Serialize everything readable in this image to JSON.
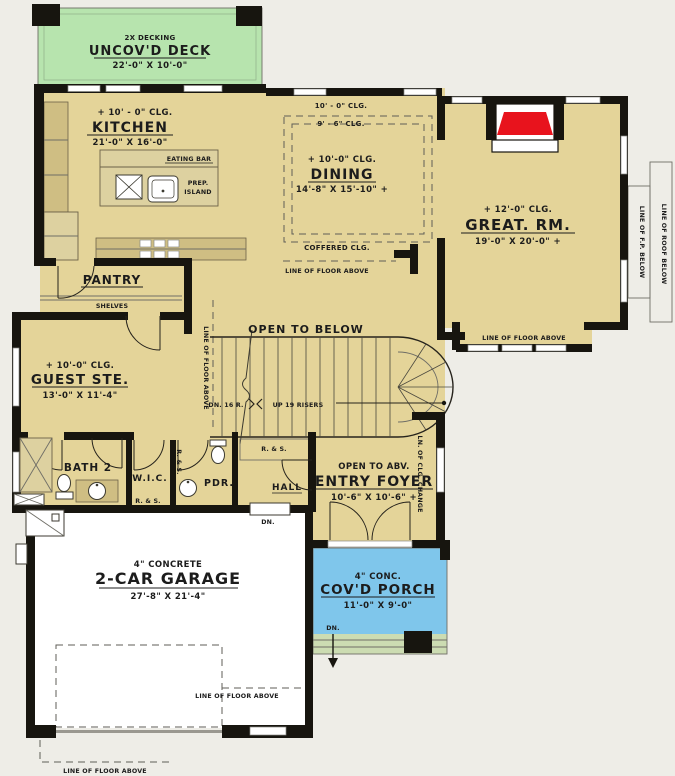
{
  "colors": {
    "background": "#eeede7",
    "floor_tan": "#e4d499",
    "deck_green": "#b7e4ae",
    "porch_blue": "#7fc6eb",
    "steps_green": "#ccdcb2",
    "garage_white": "#ffffff",
    "wall_black": "#17150f",
    "fireplace_red": "#e8131d",
    "counter_tan": "#cfbe83"
  },
  "rooms": {
    "deck": {
      "note": "2X DECKING",
      "name": "UNCOV'D DECK",
      "dims": "22'-0\" X 10'-0\""
    },
    "kitchen": {
      "clg": "+ 10' - 0\" CLG.",
      "name": "KITCHEN",
      "dims": "21'-0\" X 16'-0\""
    },
    "dining": {
      "clg_a": "10' - 0\" CLG.",
      "clg_b": "9' - 6\" CLG.",
      "clg": "+ 10'-0\" CLG.",
      "name": "DINING",
      "dims": "14'-8\" X 15'-10\" +",
      "coffered": "COFFERED CLG."
    },
    "great_room": {
      "clg": "+ 12'-0\" CLG.",
      "name": "GREAT. RM.",
      "dims": "19'-0\" X 20'-0\" +"
    },
    "pantry": {
      "name": "PANTRY",
      "shelves": "SHELVES"
    },
    "guest_suite": {
      "clg": "+ 10'-0\" CLG.",
      "name": "GUEST STE.",
      "dims": "13'-0\" X 11'-4\""
    },
    "open_below": {
      "name": "OPEN TO BELOW"
    },
    "bath2": {
      "name": "BATH 2"
    },
    "wic": {
      "name": "W.I.C."
    },
    "powder": {
      "name": "PDR."
    },
    "hall": {
      "name": "HALL"
    },
    "entry": {
      "note": "OPEN TO ABV.",
      "name": "ENTRY FOYER",
      "dims": "10'-6\" X 10'-6\" +"
    },
    "garage": {
      "note": "4\" CONCRETE",
      "name": "2-CAR GARAGE",
      "dims": "27'-8\" X 21'-4\""
    },
    "porch": {
      "note": "4\" CONC.",
      "name": "COV'D PORCH",
      "dims": "11'-0\" X 9'-0\""
    }
  },
  "annotations": {
    "line_floor_above": "LINE OF FLOOR ABOVE",
    "line_roof_below": "LINE OF ROOF BELOW",
    "line_fp_below": "LINE OF F.P. BELOW",
    "ln_clg_change": "LN. OF CLG. CHANGE",
    "eating_bar": "EATING BAR",
    "prep_island_1": "PREP.",
    "prep_island_2": "ISLAND",
    "rod_shelf": "R. & S.",
    "dn_stairs": "DN. 16 R.",
    "up_stairs": "UP 19 RISERS",
    "dn": "DN."
  }
}
